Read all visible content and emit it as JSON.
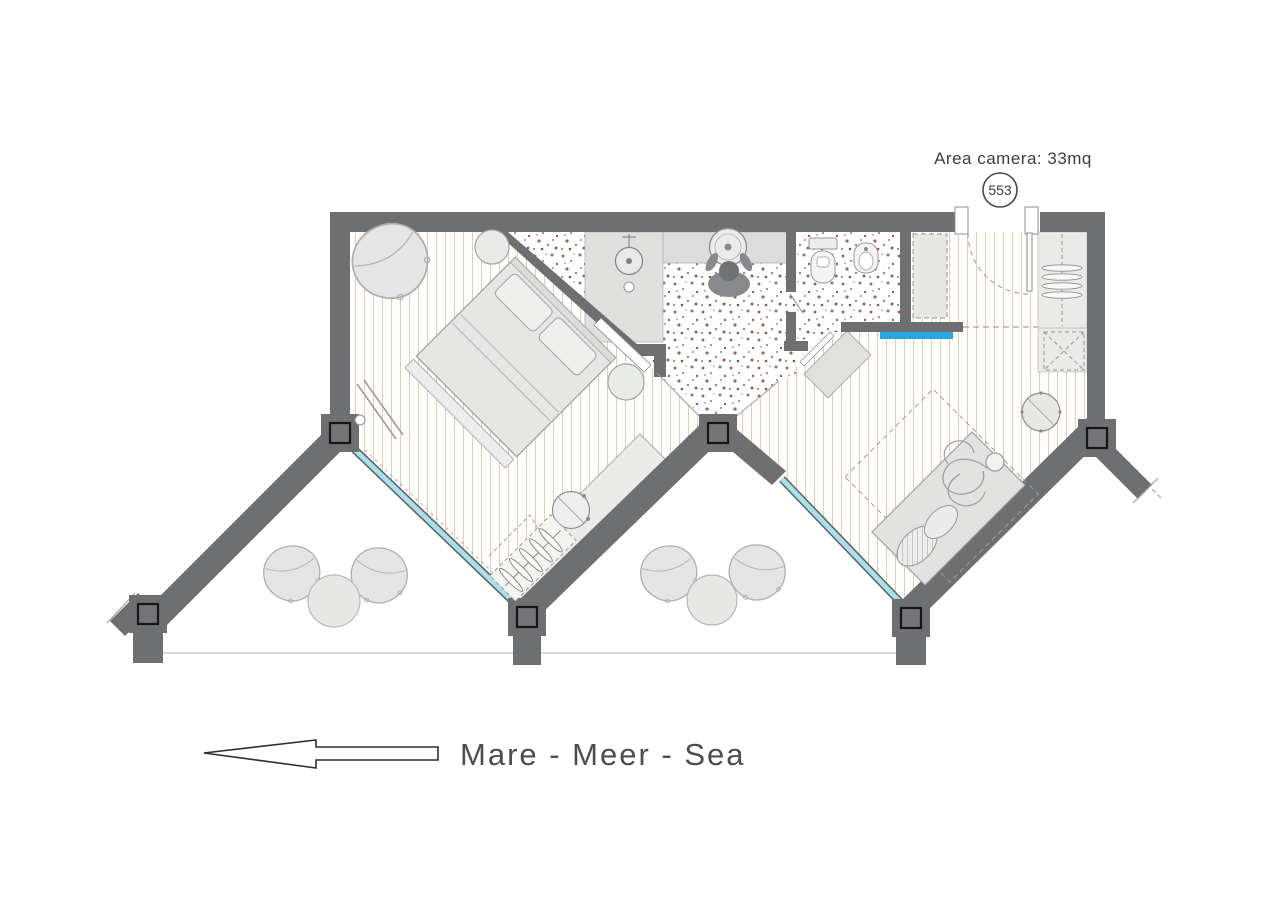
{
  "labels": {
    "area": "Area camera: 33mq",
    "room_number": "553",
    "sea_direction": "Mare - Meer - Sea"
  },
  "colors": {
    "wall": "#6e6f71",
    "floor_stripe": "#d6cfc2",
    "terrazzo_speckle": "#9a5b52",
    "window_glass": "#a8e0ec",
    "accent_blue": "#28a8e0",
    "furniture_fill": "#e5e5e4",
    "furniture_stroke": "#a8a8a8",
    "label_text": "#3d3d3d"
  },
  "icons": {
    "sea_direction_arrow": "left-arrow",
    "room_number_badge": "circle-badge"
  },
  "rooms": [
    "bedroom",
    "bathroom",
    "wc",
    "entry-hall",
    "living-room",
    "balcony"
  ],
  "furniture": [
    "double-bed",
    "pillows",
    "armchair",
    "stool",
    "side-stool",
    "floor-lamp",
    "desk",
    "desk-chair",
    "clothes-rack",
    "shower",
    "washbasin",
    "toilet",
    "bidet",
    "wardrobe",
    "luggage-rack",
    "daybed",
    "round-table",
    "lounge-chair",
    "balcony-table"
  ]
}
